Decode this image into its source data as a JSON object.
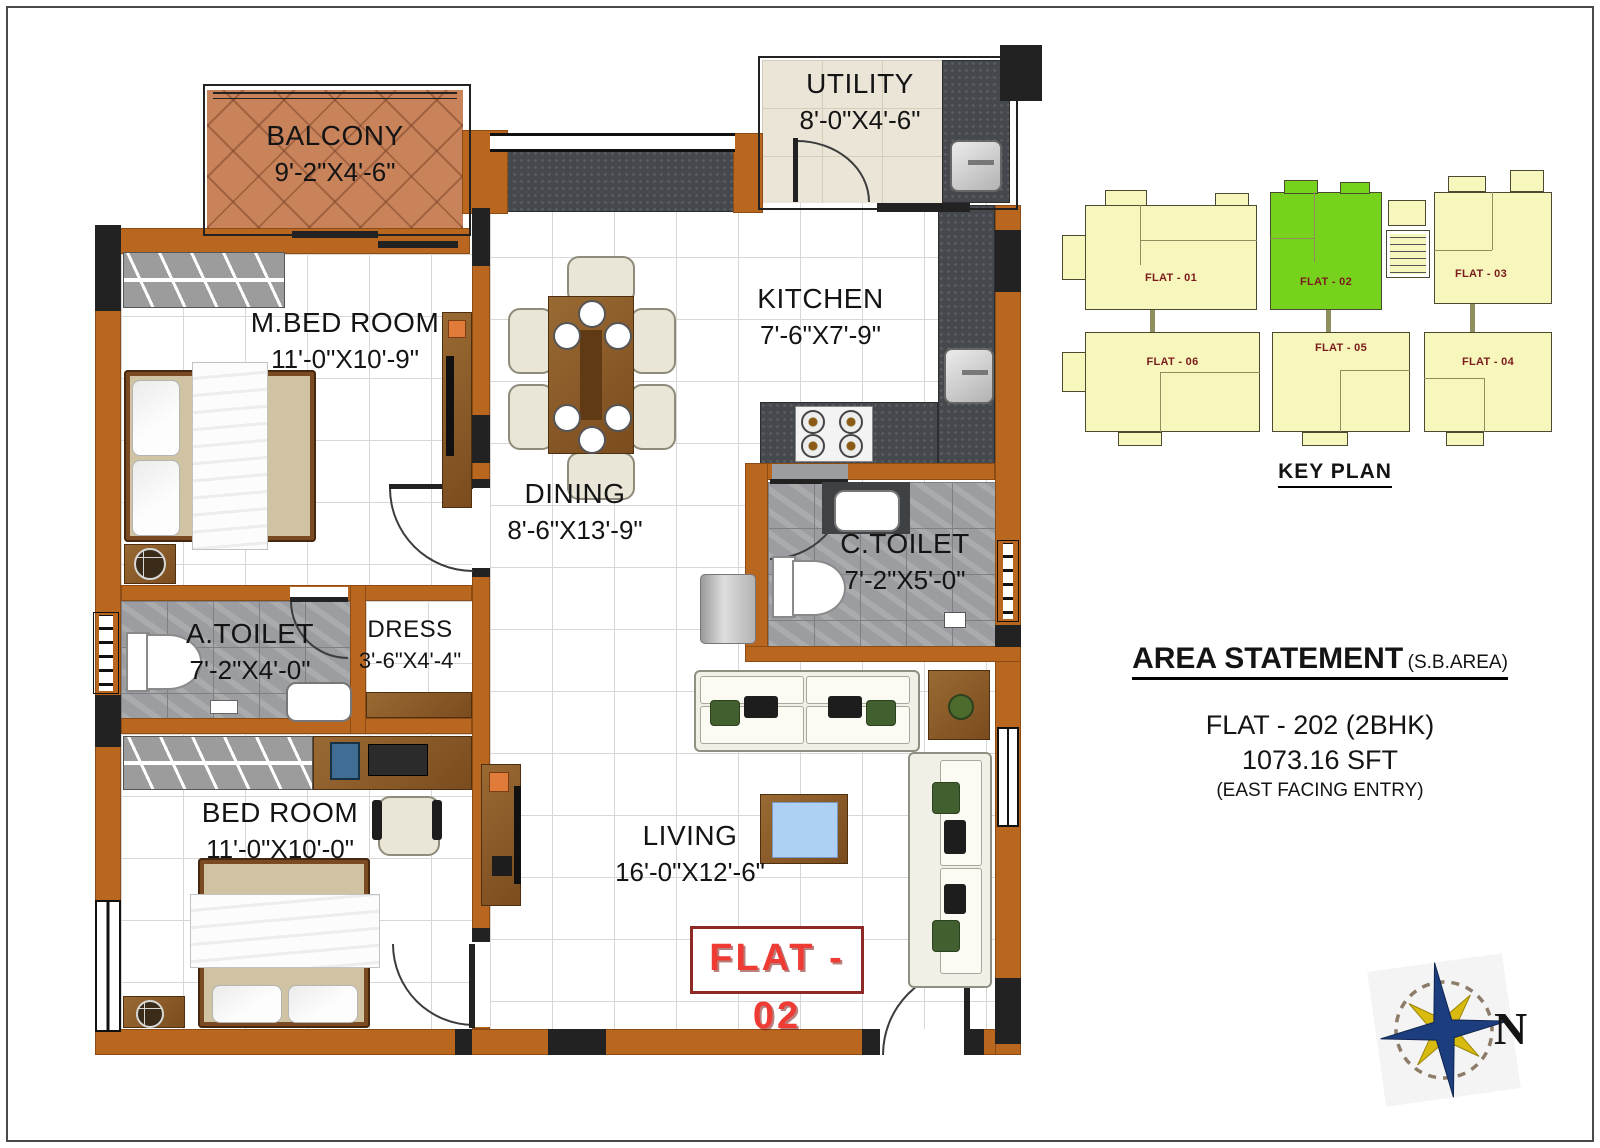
{
  "colors": {
    "wall_orange": "#b9661e",
    "keyplan_yellow": "#f6f6bd",
    "keyplan_highlight_green": "#77d21d",
    "keyplan_label_maroon": "#7b1b1b",
    "flat_badge_red": "#ee3b33",
    "compass_blue": "#1c3e7e",
    "compass_gold": "#d8bb0e"
  },
  "plan": {
    "flat_badge": "FLAT - 02",
    "rooms": {
      "balcony": {
        "name": "BALCONY",
        "dims": "9'-2\"X4'-6\""
      },
      "mbed": {
        "name": "M.BED ROOM",
        "dims": "11'-0\"X10'-9\""
      },
      "utility": {
        "name": "UTILITY",
        "dims": "8'-0\"X4'-6\""
      },
      "kitchen": {
        "name": "KITCHEN",
        "dims": "7'-6\"X7'-9\""
      },
      "dining": {
        "name": "DINING",
        "dims": "8'-6\"X13'-9\""
      },
      "ctoilet": {
        "name": "C.TOILET",
        "dims": "7'-2\"X5'-0\""
      },
      "atoilet": {
        "name": "A.TOILET",
        "dims": "7'-2\"X4'-0\""
      },
      "dress": {
        "name": "DRESS",
        "dims": "3'-6\"X4'-4\""
      },
      "bedroom": {
        "name": "BED ROOM",
        "dims": "11'-0\"X10'-0\""
      },
      "living": {
        "name": "LIVING",
        "dims": "16'-0\"X12'-6\""
      }
    }
  },
  "key_plan": {
    "title": "KEY PLAN",
    "flats": [
      {
        "label": "FLAT - 01",
        "highlighted": false
      },
      {
        "label": "FLAT - 02",
        "highlighted": true
      },
      {
        "label": "FLAT - 03",
        "highlighted": false
      },
      {
        "label": "FLAT - 06",
        "highlighted": false
      },
      {
        "label": "FLAT - 05",
        "highlighted": false
      },
      {
        "label": "FLAT - 04",
        "highlighted": false
      }
    ]
  },
  "area_statement": {
    "title": "AREA STATEMENT",
    "title_suffix": "(S.B.AREA)",
    "flat": "FLAT - 202 (2BHK)",
    "area": "1073.16 SFT",
    "facing": "(EAST FACING ENTRY)"
  },
  "compass": {
    "north": "N"
  }
}
